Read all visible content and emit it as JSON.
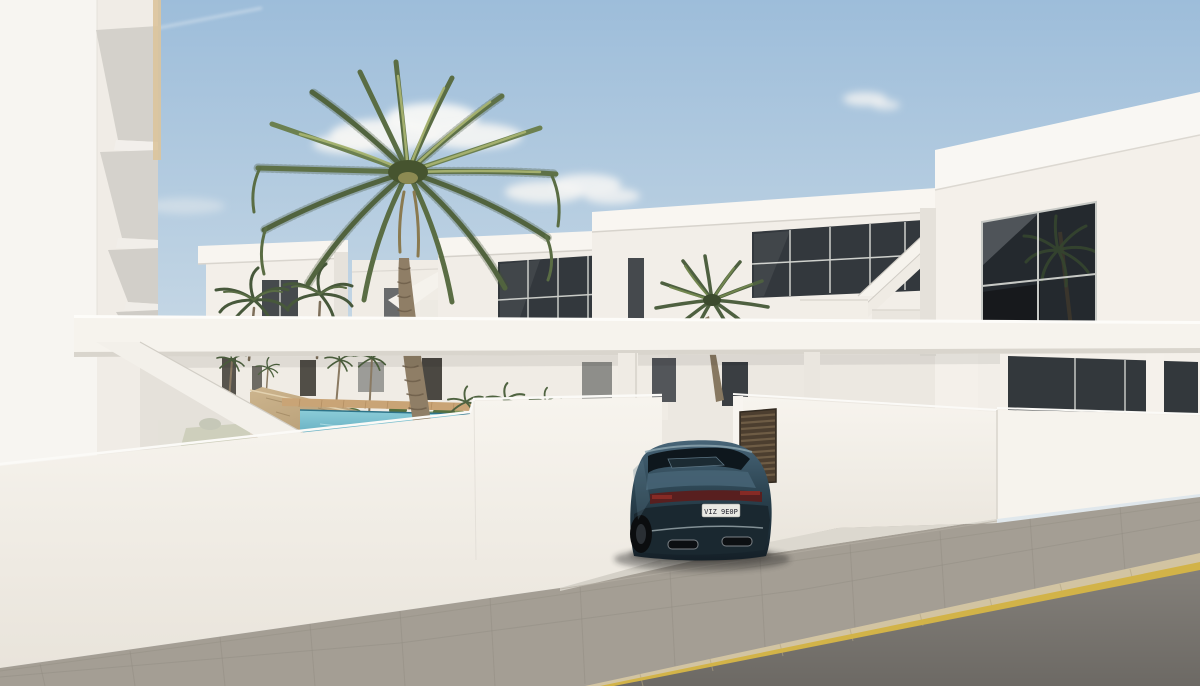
{
  "scene": {
    "type": "architectural-3d-render",
    "description": "Exterior render of a modern white residential complex of two-storey townhouses with roof terraces and external staircases, a communal courtyard with turquoise swimming pool, wooden deck and palm trees, seen from the street over white perimeter walls. A dark teal sedan is parked in a driveway; grey paved sidewalk and asphalt road with a yellow-painted curb line run across the foreground.",
    "time_of_day": "daytime, clear blue sky with light clouds"
  },
  "objects": {
    "car": {
      "type": "sedan, rear three-quarter view",
      "color_name": "dark teal blue",
      "license_plate": "VIZ 9E0P"
    },
    "pool": {
      "label": "communal swimming pool",
      "water": "turquoise"
    },
    "gate": {
      "label": "dark wooden slatted pedestrian gate"
    },
    "palm_trees": {
      "large_foreground": 1,
      "medium_midground": 1,
      "small_background": 2
    },
    "pergola_beam": {
      "label": "white horizontal walkway beam spanning the complex"
    },
    "stone_wall": {
      "label": "natural stone garden wall"
    }
  },
  "palette": {
    "sky_top": "#9dbdda",
    "sky_horizon": "#e3e9ed",
    "cloud_white": "#f6f6f4",
    "wall_white": "#f5f2ec",
    "wall_shadow": "#d8d4cd",
    "beam_white": "#f6f3ed",
    "window_dark": "#33383d",
    "window_dark_deep": "#24292e",
    "pool_water": "#6fbcce",
    "deck_wood": "#c9a476",
    "stone_wall": "#c0a37c",
    "lawn_green": "#7c9053",
    "palm_green_dark": "#55683f",
    "palm_green_light": "#93a465",
    "trunk_brown": "#8f7e66",
    "car_body": "#2e4753",
    "car_glass": "#0e171d",
    "taillight_red": "#581f1f",
    "plate_white": "#e9e9e3",
    "gate_wood": "#4c3e2f",
    "sidewalk_gray": "#a49e94",
    "road_asphalt": "#84807a",
    "curb_beige": "#d2c4a2",
    "curb_yellow_line": "#d2b348"
  }
}
